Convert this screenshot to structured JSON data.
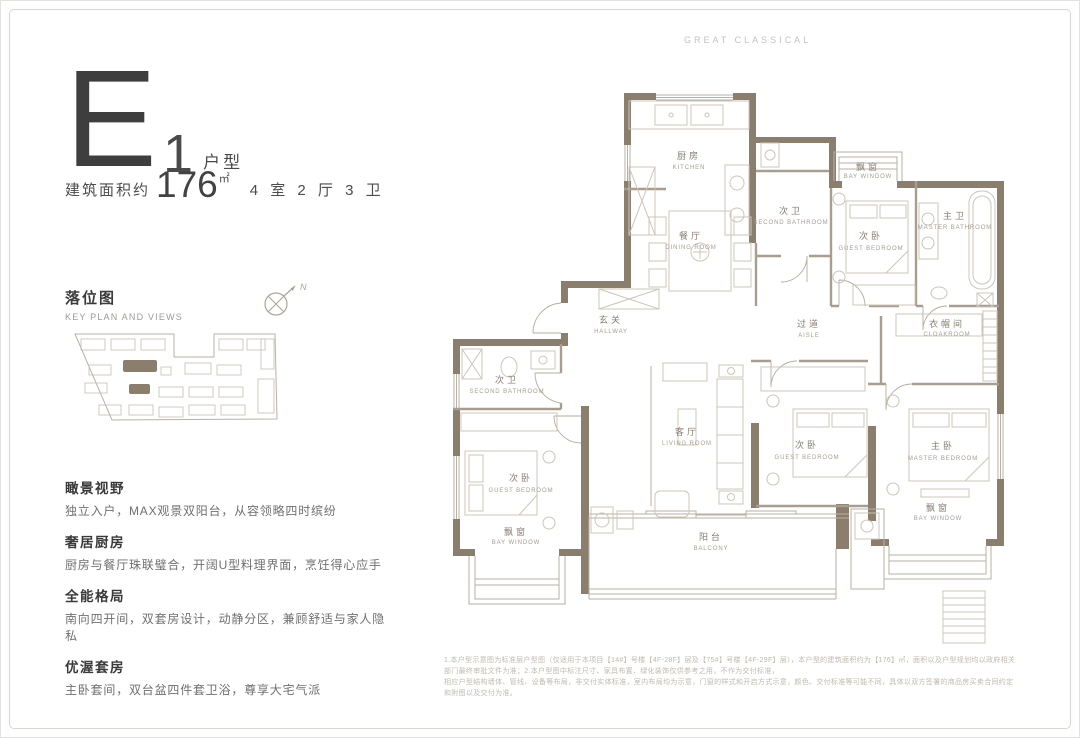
{
  "page": {
    "brand": "GREAT CLASSICAL",
    "colors": {
      "wall": "#8c7e6d",
      "line": "#b8b0a3",
      "accent_dark": "#3e3e3e"
    }
  },
  "unit": {
    "letter": "E",
    "number": "1",
    "type_label": "户型",
    "area_prefix": "建筑面积约",
    "area_value": "176",
    "area_unit": "㎡",
    "layout": "4 室 2 厅 3 卫"
  },
  "key_plan": {
    "title": "落位图",
    "subtitle": "KEY PLAN AND VIEWS",
    "compass_label": "N"
  },
  "features": [
    {
      "title": "瞰景视野",
      "desc": "独立入户，MAX观景双阳台，从容领略四时缤纷"
    },
    {
      "title": "奢居厨房",
      "desc": "厨房与餐厅珠联璧合，开阔U型料理界面，烹饪得心应手"
    },
    {
      "title": "全能格局",
      "desc": "南向四开间，双套房设计，动静分区，兼顾舒适与家人隐私"
    },
    {
      "title": "优渥套房",
      "desc": "主卧套间，双台盆四件套卫浴，尊享大宅气派"
    }
  ],
  "floor_plan": {
    "rooms": [
      {
        "id": "kitchen",
        "zh": "厨房",
        "en": "KITCHEN"
      },
      {
        "id": "dining-room",
        "zh": "餐厅",
        "en": "DINING ROOM"
      },
      {
        "id": "second-bathroom-top",
        "zh": "次卫",
        "en": "SECOND BATHROOM"
      },
      {
        "id": "bay-window-top",
        "zh": "飘窗",
        "en": "BAY WINDOW"
      },
      {
        "id": "guest-bedroom-top",
        "zh": "次卧",
        "en": "GUEST BEDROOM"
      },
      {
        "id": "master-bathroom",
        "zh": "主卫",
        "en": "MASTER BATHROOM"
      },
      {
        "id": "hallway",
        "zh": "玄关",
        "en": "HALLWAY"
      },
      {
        "id": "aisle",
        "zh": "过道",
        "en": "AISLE"
      },
      {
        "id": "cloakroom",
        "zh": "衣帽间",
        "en": "CLOAKROOM"
      },
      {
        "id": "second-bathroom-left",
        "zh": "次卫",
        "en": "SECOND BATHROOM"
      },
      {
        "id": "guest-bedroom-left",
        "zh": "次卧",
        "en": "GUEST BEDROOM"
      },
      {
        "id": "bay-window-left",
        "zh": "飘窗",
        "en": "BAY WINDOW"
      },
      {
        "id": "living-room",
        "zh": "客厅",
        "en": "LIVING ROOM"
      },
      {
        "id": "guest-bedroom-mid",
        "zh": "次卧",
        "en": "GUEST BEDROOM"
      },
      {
        "id": "master-bedroom",
        "zh": "主卧",
        "en": "MASTER BEDROOM"
      },
      {
        "id": "bay-window-right",
        "zh": "飘窗",
        "en": "BAY WINDOW"
      },
      {
        "id": "balcony",
        "zh": "阳台",
        "en": "BALCONY"
      }
    ]
  },
  "disclaimer": {
    "line1": "1.本户型示意图为标准层户型图（仅适用于本项目【14#】号楼【4F-28F】层及【75#】号楼【4F-29F】层），本户型的建筑面积约为【176】㎡，面积以及户型规划均以政府相关部门最终审批文件为准；2.本户型图中标注尺寸、家具布置、绿化装饰仅供参考之用，不作为交付标准，",
    "line2": "相应户型结构墙体、管线、设备等布局，非交付实体标准，室内布局均为示意，门窗的样式和开启方式示意，颜色、交付标准等可能不同，具体以双方签署的商品房买卖合同约定和附图以及交付为准。"
  }
}
